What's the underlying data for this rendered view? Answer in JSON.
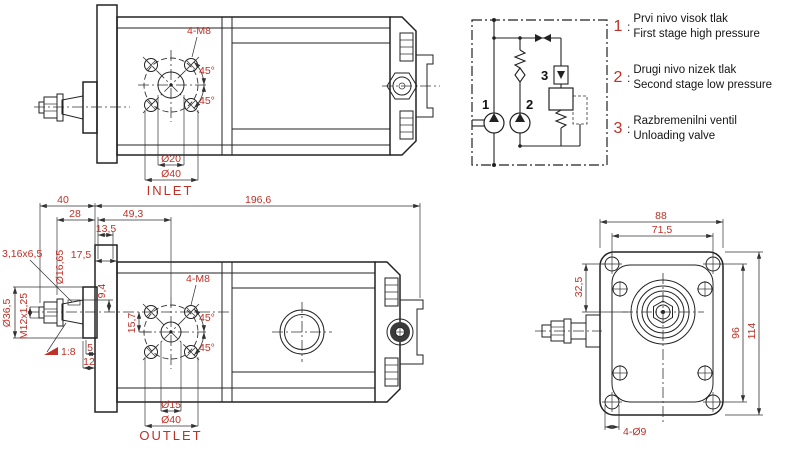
{
  "colors": {
    "dimension_text": "#bf3026",
    "drawing_line": "#222222",
    "background": "#ffffff"
  },
  "top_view": {
    "labels": {
      "bolt_pattern": "4-M8",
      "angle_top": "45°",
      "angle_bottom": "45°",
      "dia_port": "Ø20",
      "dia_bolt_circle": "Ø40",
      "port_name": "INLET"
    }
  },
  "bottom_view": {
    "labels": {
      "overall_length": "196,6",
      "len_40": "40",
      "len_28": "28",
      "len_49_3": "49,3",
      "len_13_5": "13,5",
      "key_size": "3,16x6,5",
      "dia_16_65": "Ø16,65",
      "len_17_5": "17,5",
      "off_9_4": "9,4",
      "dia_36_5": "Ø36,5",
      "thread": "M12x1,25",
      "off_15_7": "15,7",
      "bolt_pattern": "4-M8",
      "angle_top": "45°",
      "angle_bottom": "45°",
      "taper": "1:8",
      "len_5": "5",
      "len_12": "12",
      "dia_port": "Ø15",
      "dia_bolt_circle": "Ø40",
      "port_name": "OUTLET"
    }
  },
  "front_view": {
    "labels": {
      "width_88": "88",
      "width_71_5": "71,5",
      "off_32_5": "32,5",
      "height_96": "96",
      "height_114": "114",
      "corner_holes": "4-Ø9"
    }
  },
  "schematic": {
    "component_labels": {
      "pump1": "1",
      "pump2": "2",
      "valve": "3"
    },
    "legend": [
      {
        "num": "1",
        "colon": ":",
        "line1": "Prvi nivo visok tlak",
        "line2": "First stage high pressure"
      },
      {
        "num": "2",
        "colon": ":",
        "line1": "Drugi nivo nizek tlak",
        "line2": "Second stage low pressure"
      },
      {
        "num": "3",
        "colon": ":",
        "line1": "Razbremenilni ventil",
        "line2": "Unloading valve"
      }
    ]
  }
}
